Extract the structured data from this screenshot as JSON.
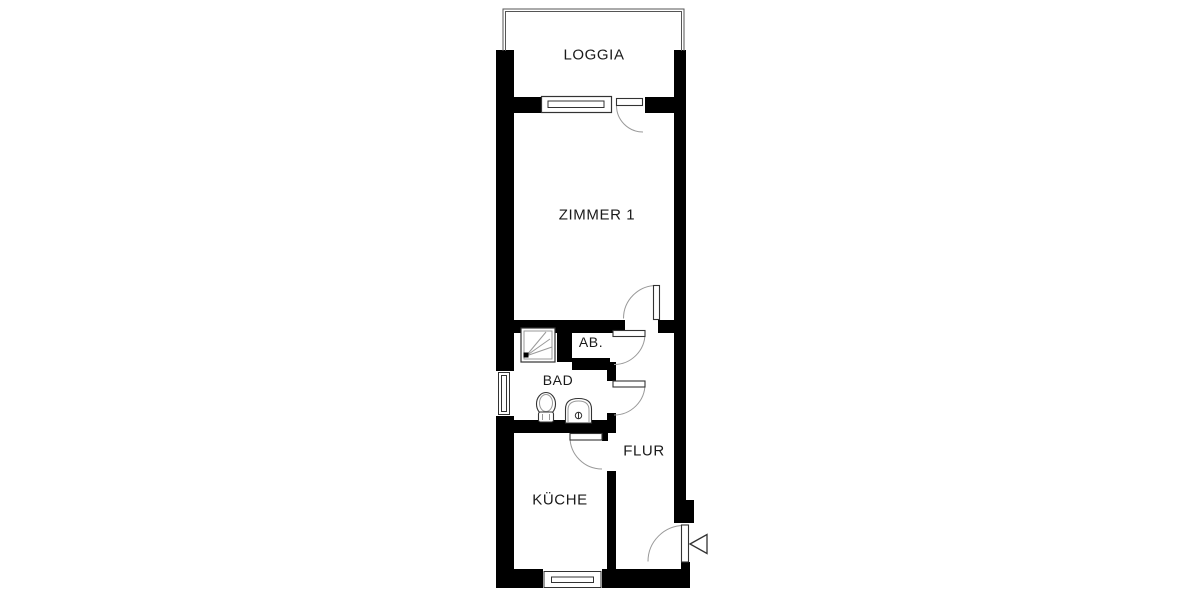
{
  "plan": {
    "type": "apartment-floor-plan",
    "rooms": [
      {
        "id": "loggia",
        "label": "LOGGIA"
      },
      {
        "id": "zimmer1",
        "label": "ZIMMER 1"
      },
      {
        "id": "ab",
        "label": "AB."
      },
      {
        "id": "bad",
        "label": "BAD"
      },
      {
        "id": "flur",
        "label": "FLUR"
      },
      {
        "id": "kueche",
        "label": "KÜCHE"
      }
    ],
    "fixtures": [
      {
        "id": "shower",
        "room": "bad"
      },
      {
        "id": "toilet",
        "room": "bad"
      },
      {
        "id": "sink",
        "room": "bad"
      }
    ],
    "doors": [
      "loggia",
      "zimmer1",
      "ab",
      "bad",
      "kueche",
      "entrance"
    ],
    "windows": [
      "loggia",
      "bad",
      "kueche"
    ],
    "entrance_marker": "triangle-arrow",
    "colors": {
      "wall": "#000000",
      "floor": "#ffffff",
      "swing_line": "#999999",
      "frame_line": "#333333",
      "railing_line": "#555555",
      "text": "#1a1a1a"
    }
  }
}
